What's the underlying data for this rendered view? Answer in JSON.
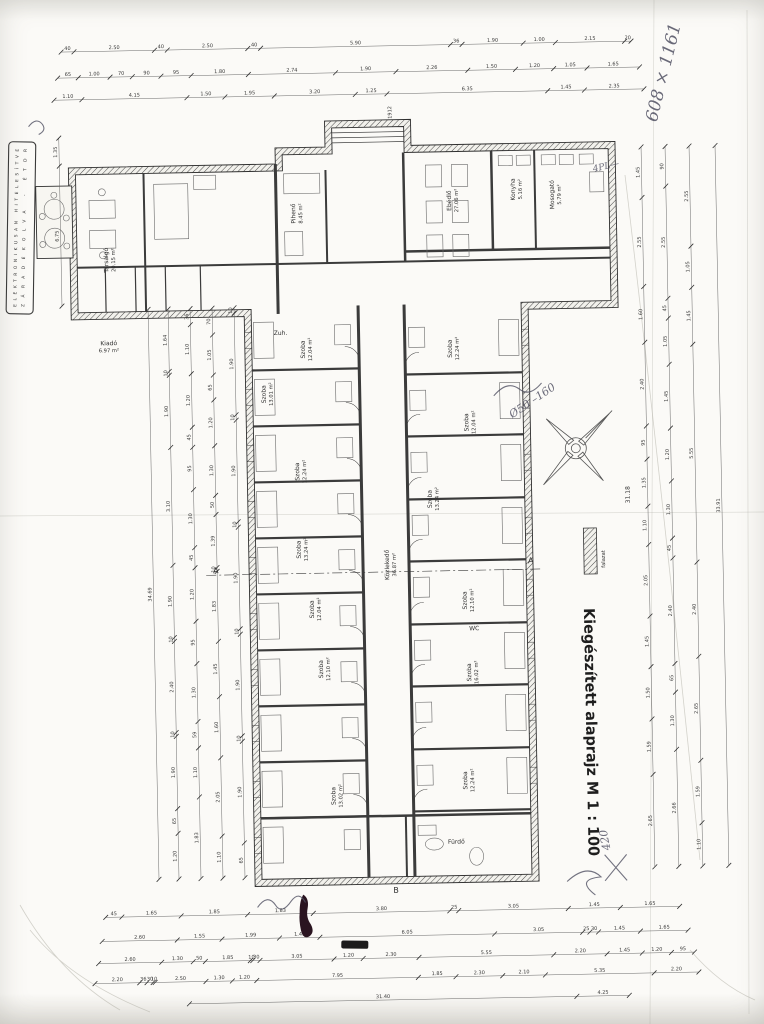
{
  "document": {
    "title": "Kiegészített alaprajz M 1 : 100",
    "stamp_line1": "ELEKTRONIKUSAN HITELESÍTVE",
    "stamp_line2": "ZÁRADÉKOLVA  -  ÉTDR",
    "legend_label": "falazat"
  },
  "plan": {
    "rooms": [
      {
        "name": "Társalgó",
        "area": "20.15 m²",
        "x": 113,
        "y": 255,
        "r": -90
      },
      {
        "name": "Pihenő",
        "area": "8.45 m²",
        "x": 301,
        "y": 212,
        "r": -90
      },
      {
        "name": "Ebédlő",
        "area": "27.06 m²",
        "x": 457,
        "y": 202,
        "r": -90
      },
      {
        "name": "Konyha",
        "area": "5.16 m²",
        "x": 521,
        "y": 192,
        "r": -90
      },
      {
        "name": "Mosogató",
        "area": "5.79 m²",
        "x": 560,
        "y": 198,
        "r": -90
      },
      {
        "name": "Kiadó",
        "area": "6.97 m²",
        "x": 112,
        "y": 340,
        "r": 0
      },
      {
        "name": "Zuh.",
        "area": "",
        "x": 284,
        "y": 333,
        "r": 0
      },
      {
        "name": "Szoba",
        "area": "12.04 m²",
        "x": 308,
        "y": 348,
        "r": -90
      },
      {
        "name": "Szoba",
        "area": "13.01 m²",
        "x": 268,
        "y": 392,
        "r": -90
      },
      {
        "name": "Szoba",
        "area": "12.24 m²",
        "x": 300,
        "y": 470,
        "r": -90
      },
      {
        "name": "Szoba",
        "area": "13.24 m²",
        "x": 300,
        "y": 548,
        "r": -90
      },
      {
        "name": "Szoba",
        "area": "12.04 m²",
        "x": 312,
        "y": 608,
        "r": -90
      },
      {
        "name": "Szoba",
        "area": "12.10 m²",
        "x": 320,
        "y": 668,
        "r": -90
      },
      {
        "name": "Szoba",
        "area": "13.02 m²",
        "x": 330,
        "y": 795,
        "r": -90
      },
      {
        "name": "Szoba",
        "area": "12.24 m²",
        "x": 455,
        "y": 350,
        "r": -90
      },
      {
        "name": "Szoba",
        "area": "12.04 m²",
        "x": 470,
        "y": 424,
        "r": -90
      },
      {
        "name": "Szoba",
        "area": "13.24 m²",
        "x": 432,
        "y": 500,
        "r": -90
      },
      {
        "name": "Szoba",
        "area": "12.10 m²",
        "x": 465,
        "y": 602,
        "r": -90
      },
      {
        "name": "Szoba",
        "area": "16.02 m²",
        "x": 468,
        "y": 674,
        "r": -90
      },
      {
        "name": "Szoba",
        "area": "12.24 m²",
        "x": 462,
        "y": 782,
        "r": -90
      },
      {
        "name": "Közlekedő",
        "area": "36.87 m²",
        "x": 388,
        "y": 565,
        "r": -90
      },
      {
        "name": "WC",
        "area": "",
        "x": 472,
        "y": 632,
        "r": 0
      },
      {
        "name": "Fürdő",
        "area": "",
        "x": 450,
        "y": 845,
        "r": 0
      }
    ],
    "annotations": [
      {
        "text": "608 × 1161",
        "x": 664,
        "y": 128,
        "r": -75,
        "size": 17,
        "style": "hand"
      },
      {
        "text": "4PL—",
        "x": 600,
        "y": 176,
        "r": -12,
        "size": 9,
        "style": "hand"
      },
      {
        "text": "Ø50 –160",
        "x": 514,
        "y": 421,
        "r": -33,
        "size": 11,
        "style": "hand"
      },
      {
        "text": "420",
        "x": 604,
        "y": 854,
        "r": -100,
        "size": 11,
        "style": "hand"
      },
      {
        "text": "31.18",
        "x": 630,
        "y": 508,
        "r": -90,
        "size": 6,
        "style": "plain"
      },
      {
        "text": "1912",
        "x": 399,
        "y": 119,
        "r": -90,
        "size": 5,
        "style": "plain"
      },
      {
        "text": "A",
        "x": 212,
        "y": 570,
        "r": 0,
        "size": 8,
        "style": "plain"
      },
      {
        "text": "A",
        "x": 527,
        "y": 566,
        "r": 0,
        "size": 8,
        "style": "plain"
      },
      {
        "text": "B",
        "x": 386,
        "y": 893,
        "r": 0,
        "size": 8,
        "style": "plain"
      }
    ]
  },
  "dimensions": {
    "chains": [
      {
        "o": "h",
        "p": 46,
        "a": 70,
        "b": 640,
        "v": [
          "40",
          "2.50",
          "40",
          "2.50",
          "40",
          "5.90",
          "36",
          "1.90",
          "1.00",
          "2.15",
          "20"
        ]
      },
      {
        "o": "h",
        "p": 72,
        "a": 66,
        "b": 648,
        "v": [
          "65",
          "1.00",
          "70",
          "90",
          "95",
          "1.80",
          "2.74",
          "1.90",
          "2.26",
          "1.50",
          "1.20",
          "1.05",
          "1.65"
        ]
      },
      {
        "o": "h",
        "p": 94,
        "a": 62,
        "b": 652,
        "v": [
          "1.10",
          "4.15",
          "1.50",
          "1.95",
          "3.20",
          "1.25",
          "6.35",
          "1.45",
          "2.35"
        ]
      },
      {
        "o": "h",
        "p": 912,
        "a": 98,
        "b": 672,
        "v": [
          "45",
          "1.65",
          "1.85",
          "1.83",
          "3.80",
          "25",
          "3.05",
          "1.45",
          "1.65"
        ]
      },
      {
        "o": "h",
        "p": 936,
        "a": 94,
        "b": 680,
        "v": [
          "2.60",
          "1.55",
          "1.99",
          "1.40",
          "6.05",
          "3.05",
          "25",
          "30",
          "1.45",
          "1.65"
        ]
      },
      {
        "o": "h",
        "p": 958,
        "a": 90,
        "b": 686,
        "v": [
          "2.60",
          "1.30",
          "50",
          "1.85",
          "10",
          "30",
          "3.05",
          "1.20",
          "2.30",
          "5.55",
          "2.20",
          "1.45",
          "1.20",
          "95"
        ]
      },
      {
        "o": "h",
        "p": 978,
        "a": 86,
        "b": 690,
        "v": [
          "2.20",
          "36",
          "30",
          "10",
          "2.50",
          "1.30",
          "1.20",
          "7.95",
          "1.85",
          "2.30",
          "2.10",
          "5.35",
          "2.20"
        ]
      },
      {
        "o": "h",
        "p": 1000,
        "a": 180,
        "b": 620,
        "v": [
          "31.40",
          "4.25"
        ]
      },
      {
        "o": "v",
        "p": 66,
        "a": 132,
        "b": 300,
        "v": [
          "1.35",
          "6.75"
        ]
      },
      {
        "o": "v",
        "p": 152,
        "a": 305,
        "b": 875,
        "v": [
          "34.69"
        ]
      },
      {
        "o": "v",
        "p": 172,
        "a": 305,
        "b": 875,
        "v": [
          "1.64",
          "10",
          "1.90",
          "3.10",
          "1.90",
          "10",
          "2.40",
          "10",
          "1.90",
          "65",
          "1.20"
        ]
      },
      {
        "o": "v",
        "p": 194,
        "a": 305,
        "b": 875,
        "v": [
          "36",
          "1.10",
          "1.20",
          "45",
          "95",
          "1.30",
          "45",
          "1.20",
          "95",
          "1.30",
          "59",
          "1.10",
          "1.83"
        ]
      },
      {
        "o": "v",
        "p": 216,
        "a": 305,
        "b": 875,
        "v": [
          "70",
          "1.05",
          "65",
          "1.20",
          "1.30",
          "50",
          "1.39",
          "10",
          "1.83",
          "1.45",
          "1.60",
          "2.05",
          "1.10"
        ]
      },
      {
        "o": "v",
        "p": 238,
        "a": 305,
        "b": 875,
        "v": [
          "10",
          "1.90",
          "10",
          "1.90",
          "10",
          "1.90",
          "10",
          "1.90",
          "10",
          "1.90",
          "65"
        ]
      },
      {
        "o": "v",
        "p": 648,
        "a": 152,
        "b": 872,
        "v": [
          "1.45",
          "2.55",
          "1.60",
          "2.40",
          "95",
          "1.35",
          "1.10",
          "2.05",
          "1.45",
          "1.50",
          "1.59",
          "2.65"
        ]
      },
      {
        "o": "v",
        "p": 672,
        "a": 152,
        "b": 872,
        "v": [
          "90",
          "2.55",
          "45",
          "1.05",
          "1.45",
          "1.20",
          "1.30",
          "45",
          "2.40",
          "65",
          "1.30",
          "2.66"
        ]
      },
      {
        "o": "v",
        "p": 696,
        "a": 152,
        "b": 872,
        "v": [
          "2.55",
          "1.05",
          "1.45",
          "5.55",
          "2.40",
          "2.65",
          "1.59",
          "1.10"
        ]
      },
      {
        "o": "v",
        "p": 722,
        "a": 152,
        "b": 872,
        "v": [
          "33.91"
        ]
      }
    ]
  }
}
